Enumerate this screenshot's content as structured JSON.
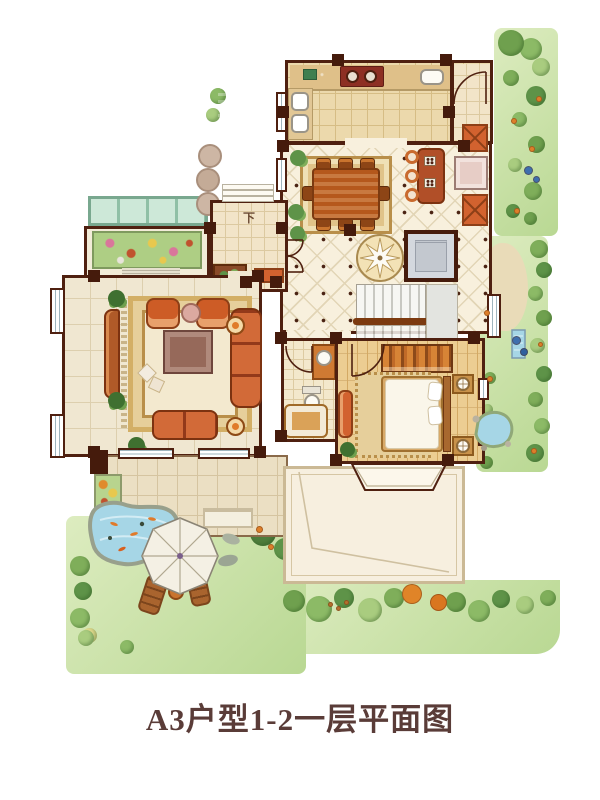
{
  "title": "A3户型1-2一层平面图",
  "labels": {
    "entry_steps_down": "下"
  },
  "palette": {
    "wall": "#4f2010",
    "floor_cream": "#f8f0dd",
    "garden_green": "#b9d893",
    "water_blue": "#a6d6e6",
    "furniture_orange": "#c9571f",
    "wood_brown": "#b5581c",
    "elevator_gray": "#d4d8de",
    "canopy_teal": "#cde8d8",
    "title_text": "#5a3c38"
  }
}
